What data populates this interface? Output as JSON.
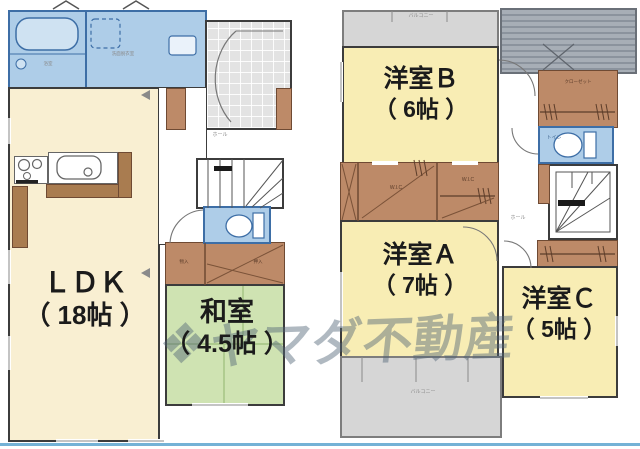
{
  "watermark": {
    "logo_glyph": "❖",
    "text": "ヤマダ不動産"
  },
  "floor1": {
    "ldk": {
      "name": "ＬＤＫ",
      "size": "（ 18帖 ）"
    },
    "washitsu": {
      "name": "和室",
      "size": "（ 4.5帖 ）"
    },
    "bath_label": "浴室",
    "washroom_label": "洗面脱衣室",
    "hall_label": "ホール",
    "closet_small_label": "物入",
    "closet_oshiire_label": "押入"
  },
  "floor2": {
    "room_b": {
      "name": "洋室Ｂ",
      "size": "（ 6帖 ）"
    },
    "room_a": {
      "name": "洋室Ａ",
      "size": "（ 7帖 ）"
    },
    "room_c": {
      "name": "洋室Ｃ",
      "size": "（ 5帖 ）"
    },
    "balcony_top_label": "バルコニー",
    "balcony_bottom_label": "バルコニー",
    "closet_label": "クローゼット",
    "wic_label_1": "W.I.C",
    "wic_label_2": "W.I.C",
    "toilet_label": "トイレ",
    "hall_label": "ホール"
  },
  "colors": {
    "ldk_cream": "#f9efd2",
    "western_room_yellow": "#f8edb4",
    "tatami_green": "#cfe3b2",
    "wet_area_blue": "#aecde8",
    "closet_brown": "#bd8a68",
    "balcony_gray": "#d6d6d6",
    "roof_gray": "#9aa2ac",
    "wall_line": "#3c3c3c",
    "bottom_accent_blue": "#74b2d6",
    "watermark_gray": "#50647680"
  }
}
